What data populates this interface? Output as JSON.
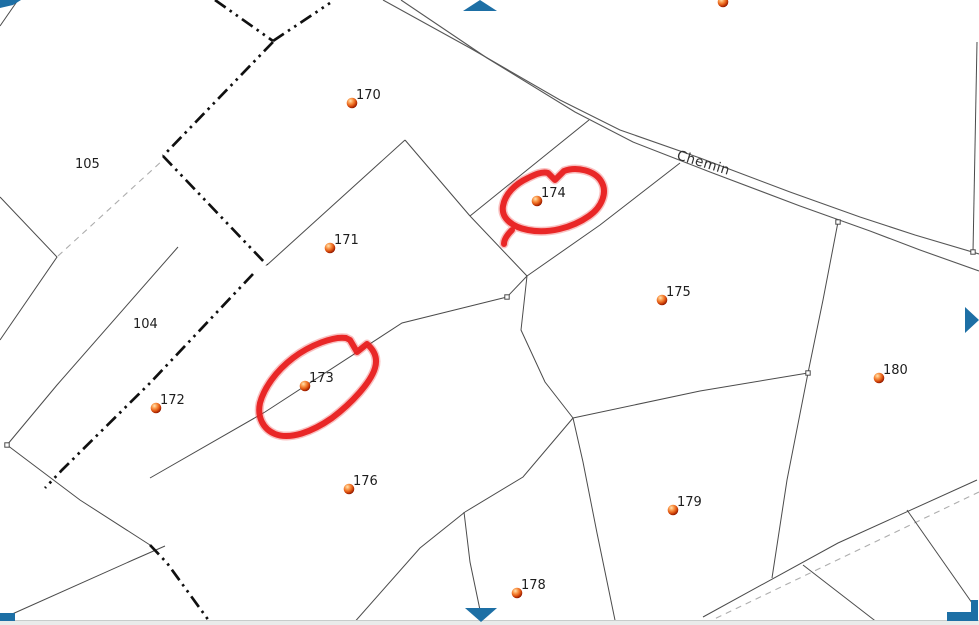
{
  "canvas": {
    "width": 979,
    "height": 625,
    "background": "#ffffff"
  },
  "colors": {
    "parcel_line": "#4b4b4b",
    "road_line": "#565656",
    "commune_boundary": "#101010",
    "survey_dashed": "#adadad",
    "label_text": "#1d1d1d",
    "road_label_text": "#303030",
    "annotation_red": "#e81f1f",
    "pan_arrow_blue": "#1d6fa5",
    "dot_highlight": "#ffe3b3",
    "dot_mid": "#e65f17",
    "dot_edge": "#801500",
    "bottom_bar_fill": "#e9ebea",
    "bottom_bar_border": "#c8cccb"
  },
  "road": {
    "label": "Chemin",
    "label_x": 676,
    "label_y": 159,
    "label_rotation_deg": 17,
    "upper": [
      [
        383,
        0
      ],
      [
        470,
        48
      ],
      [
        560,
        100
      ],
      [
        620,
        130
      ],
      [
        700,
        158
      ],
      [
        790,
        192
      ],
      [
        860,
        217
      ],
      [
        915,
        235
      ],
      [
        979,
        254
      ]
    ],
    "lower": [
      [
        401,
        0
      ],
      [
        487,
        58
      ],
      [
        575,
        112
      ],
      [
        633,
        142
      ],
      [
        710,
        172
      ],
      [
        800,
        206
      ],
      [
        870,
        231
      ],
      [
        920,
        250
      ],
      [
        979,
        271
      ]
    ]
  },
  "parcel_lines": [
    [
      [
        18,
        0
      ],
      [
        0,
        26
      ]
    ],
    [
      [
        0,
        197
      ],
      [
        57,
        257
      ],
      [
        0,
        340
      ]
    ],
    [
      [
        178,
        247
      ],
      [
        57,
        385
      ],
      [
        7,
        445
      ]
    ],
    [
      [
        7,
        445
      ],
      [
        80,
        500
      ],
      [
        150,
        545
      ]
    ],
    [
      [
        0,
        621
      ],
      [
        10,
        615
      ],
      [
        133,
        560
      ],
      [
        165,
        546
      ]
    ],
    [
      [
        405,
        140
      ],
      [
        267,
        265
      ]
    ],
    [
      [
        405,
        140
      ],
      [
        470,
        216
      ]
    ],
    [
      [
        589,
        120
      ],
      [
        470,
        216
      ]
    ],
    [
      [
        470,
        216
      ],
      [
        527,
        276
      ]
    ],
    [
      [
        527,
        276
      ],
      [
        521,
        330
      ],
      [
        545,
        382
      ],
      [
        573,
        418
      ]
    ],
    [
      [
        527,
        276
      ],
      [
        507,
        297
      ]
    ],
    [
      [
        150,
        478
      ],
      [
        265,
        412
      ],
      [
        402,
        323
      ],
      [
        507,
        297
      ]
    ],
    [
      [
        680,
        163
      ],
      [
        600,
        225
      ],
      [
        527,
        276
      ]
    ],
    [
      [
        838,
        222
      ],
      [
        823,
        300
      ],
      [
        808,
        373
      ]
    ],
    [
      [
        977,
        42
      ],
      [
        973,
        252
      ]
    ],
    [
      [
        573,
        418
      ],
      [
        700,
        391
      ],
      [
        808,
        373
      ]
    ],
    [
      [
        808,
        373
      ],
      [
        787,
        480
      ],
      [
        772,
        578
      ]
    ],
    [
      [
        573,
        418
      ],
      [
        583,
        462
      ],
      [
        597,
        533
      ],
      [
        616,
        625
      ]
    ],
    [
      [
        573,
        418
      ],
      [
        523,
        477
      ],
      [
        465,
        512
      ]
    ],
    [
      [
        465,
        512
      ],
      [
        420,
        548
      ],
      [
        352,
        625
      ]
    ],
    [
      [
        464,
        512
      ],
      [
        470,
        562
      ],
      [
        480,
        610
      ]
    ],
    [
      [
        703,
        617
      ],
      [
        838,
        543
      ],
      [
        977,
        480
      ]
    ],
    [
      [
        803,
        565
      ],
      [
        878,
        623
      ]
    ],
    [
      [
        907,
        510
      ],
      [
        977,
        610
      ]
    ]
  ],
  "boundary_chains": [
    [
      [
        215,
        0
      ],
      [
        273,
        41
      ]
    ],
    [
      [
        273,
        41
      ],
      [
        330,
        3
      ]
    ],
    [
      [
        273,
        42
      ],
      [
        163,
        156
      ]
    ],
    [
      [
        163,
        156
      ],
      [
        267,
        265
      ]
    ],
    [
      [
        253,
        274
      ],
      [
        150,
        383
      ],
      [
        62,
        470
      ],
      [
        45,
        488
      ]
    ],
    [
      [
        150,
        545
      ],
      [
        167,
        563
      ],
      [
        212,
        625
      ]
    ]
  ],
  "dashed_lines": [
    [
      [
        58,
        256
      ],
      [
        163,
        160
      ]
    ],
    [
      [
        706,
        623
      ],
      [
        979,
        492
      ]
    ]
  ],
  "vertex_markers": [
    [
      838,
      222
    ],
    [
      973,
      252
    ],
    [
      7,
      445
    ],
    [
      507,
      297
    ],
    [
      808,
      373
    ]
  ],
  "parcel_points": [
    {
      "label": "",
      "x": 723,
      "y": 2
    },
    {
      "label": "170",
      "x": 352,
      "y": 103
    },
    {
      "label": "171",
      "x": 330,
      "y": 248
    },
    {
      "label": "172",
      "x": 156,
      "y": 408
    },
    {
      "label": "173",
      "x": 305,
      "y": 386
    },
    {
      "label": "174",
      "x": 537,
      "y": 201
    },
    {
      "label": "175",
      "x": 662,
      "y": 300
    },
    {
      "label": "176",
      "x": 349,
      "y": 489
    },
    {
      "label": "178",
      "x": 517,
      "y": 593
    },
    {
      "label": "179",
      "x": 673,
      "y": 510
    },
    {
      "label": "180",
      "x": 879,
      "y": 378
    }
  ],
  "area_labels": [
    {
      "text": "105",
      "x": 75,
      "y": 168
    },
    {
      "text": "104",
      "x": 133,
      "y": 328
    }
  ],
  "annotations": [
    {
      "name": "highlight-circle-174",
      "path": "M548,173 L555,180 L564,171 C577,166 595,171 601,181 C608,192 602,207 589,216 C572,228 548,234 528,230 C512,227 501,218 503,206 C505,194 515,184 528,178 C534,175 542,171 548,173 M512,230 C507,235 504,240 504,244"
    },
    {
      "name": "highlight-circle-173",
      "path": "M350,340 L357,352 L367,344 C374,350 378,358 375,368 C371,382 352,403 332,418 C312,432 290,440 275,434 C263,429 257,417 260,403 C264,388 276,371 293,358 C310,345 334,336 346,338 L350,340"
    }
  ],
  "pan_arrows": [
    {
      "name": "pan-up",
      "points": "463,11 497,11 480,0"
    },
    {
      "name": "pan-right",
      "points": "965,307 979,320 965,333"
    },
    {
      "name": "pan-down",
      "points": "465,608 497,608 481,622"
    },
    {
      "name": "pan-up-left",
      "points": "0,0 21,0 13,5 0,8"
    },
    {
      "name": "pan-down-left",
      "points": "0,613 15,613 15,621 0,621"
    },
    {
      "name": "pan-down-right",
      "points": "947,612 971,612 971,600 978,600 978,621 947,621"
    }
  ],
  "bottom_bar": {
    "y": 620,
    "height": 5
  }
}
